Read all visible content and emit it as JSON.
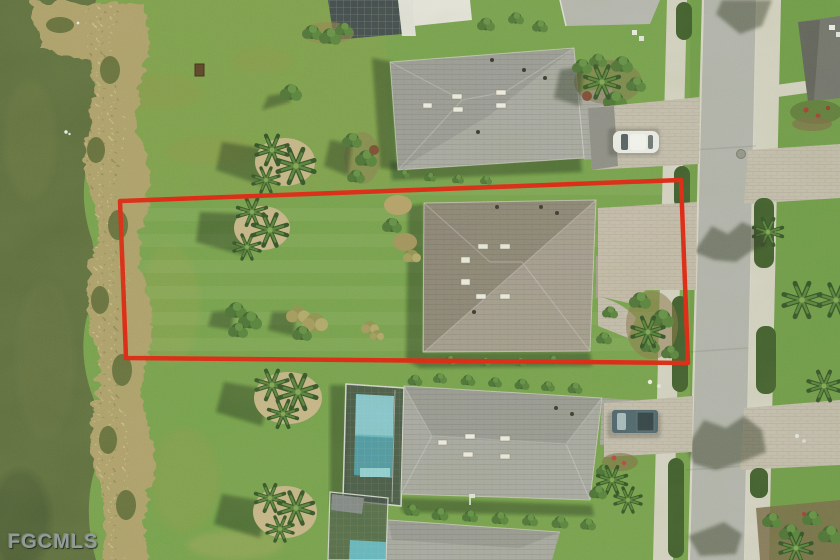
{
  "watermark": {
    "text": "FGCMLS"
  },
  "palette": {
    "boundary": "#e4200f",
    "lake": "#5b6b3d",
    "shore": "#b1a06c",
    "lawn": "#74a14c",
    "lawn_dry": "#92a45c",
    "road": "#b4b5b1",
    "sidewalk": "#d8d5c8",
    "driveway": "#c7bfb2",
    "roof_dark": "#8c8378",
    "roof_light": "#a59c91",
    "neighbor_roof": "#a9a9a5",
    "hedge": "#3c5a2b",
    "pool": "#62b8c5",
    "truck": "#49616f",
    "car": "#f1f2f0",
    "sand": "#c9b789",
    "watermark": "#939b99"
  }
}
